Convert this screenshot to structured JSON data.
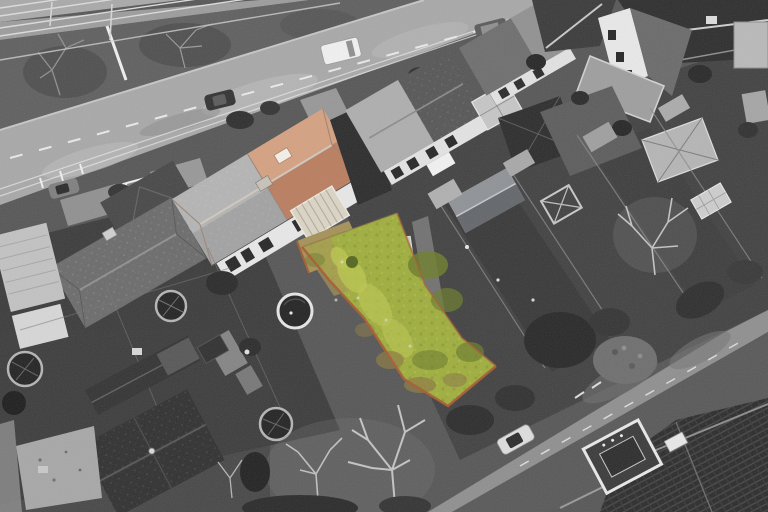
{
  "scene": {
    "alt": "Aerial drone photograph of a suburban street; image is desaturated to grayscale except the marketed property: a semi-detached house with a terracotta hipped roof, conservatory, shed and a long yellow-green rear garden plot outlined by an orange-brown boundary fence. A main road with vehicles crosses the upper left, a second road crosses the lower right.",
    "colors": {
      "ground_base": "#565656",
      "garden_dark": "#3a3a3a",
      "garden_mid": "#454545",
      "paving": "#9a9a9a",
      "verge": "#5f5f5f",
      "railway": "#a9a9a9",
      "rail_line": "#dcdcdc",
      "road_main": "#a8a8a8",
      "road_marking": "#f1f1f1",
      "road_secondary": "#585858",
      "sidewalk": "#8f8f8f",
      "roof_dark": "#303030",
      "roof_mid": "#6b6b6b",
      "roof_light": "#b4b4b4",
      "wall_white": "#e8e8e8",
      "window_dark": "#262626",
      "tree_branch": "#c4c4c4",
      "bush_dark": "#2a2a2a",
      "trampoline_mat": "#232323",
      "trampoline_rim": "#b5b5b5",
      "pool_rim": "#e6e6e6",
      "car_white": "#f1f1f1",
      "car_silver": "#dedede",
      "car_dark": "#323232",
      "car_gray": "#7f7f7f",
      "highlight_roof": "#c8886a",
      "highlight_roof_light": "#e0b694",
      "highlight_roof_ridge": "#8e5a40",
      "skylight": "#f4f1e9",
      "conservatory": "#dbd5c6",
      "conservatory_stripe": "#b3ab99",
      "patio": "#a59158",
      "shed_roof": "#98a287",
      "shed_ridge": "#ccd2c3",
      "greenhouse": "#c3c7ba",
      "grass": "#9fae3d",
      "grass_light": "#bac54e",
      "grass_dark": "#6c7c2b",
      "grass_brown": "#8d7a42",
      "soil": "#a89552",
      "fence_orange": "#a85c30"
    }
  }
}
